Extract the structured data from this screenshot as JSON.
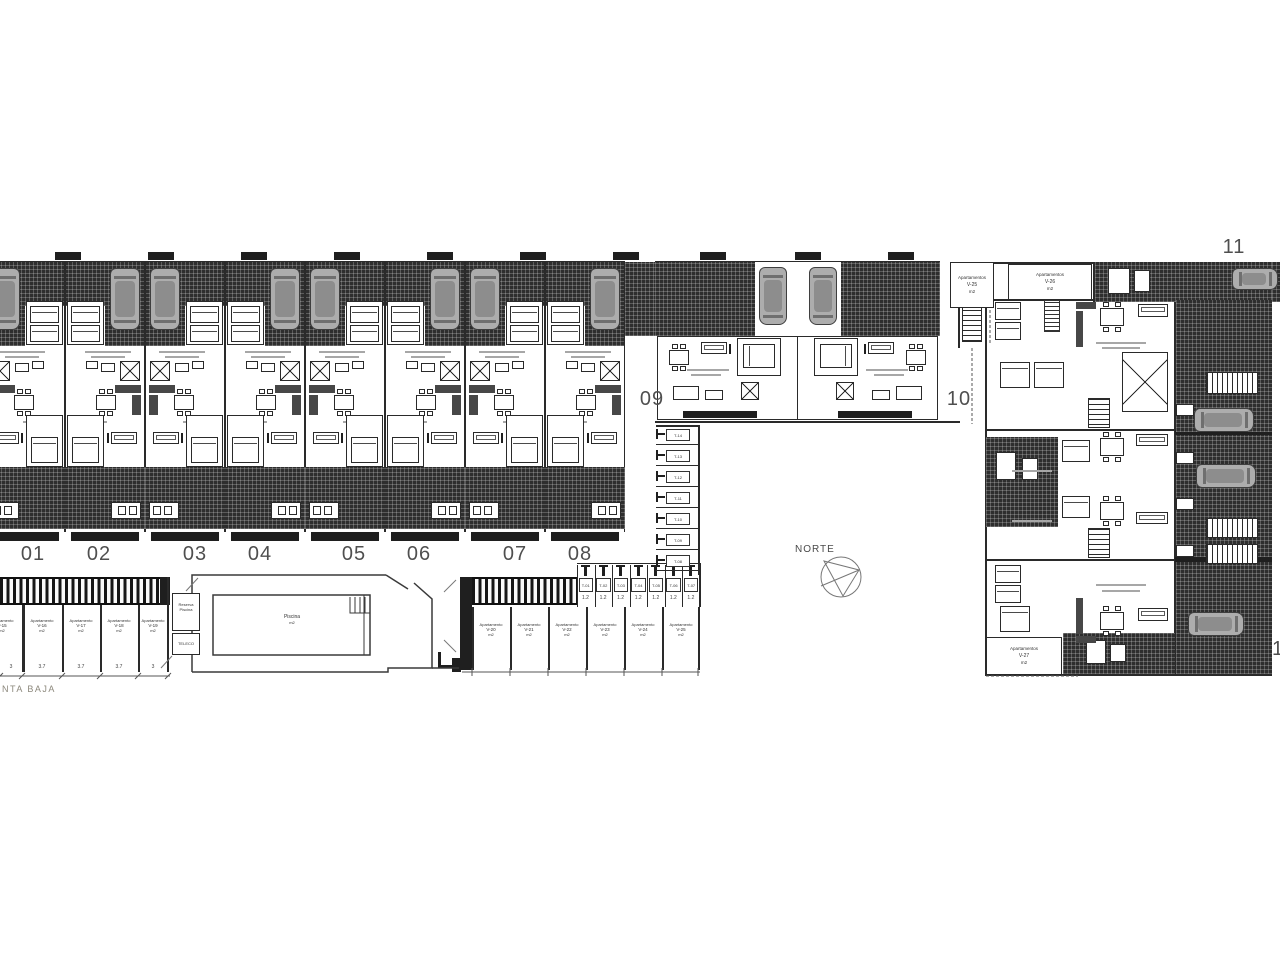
{
  "plan": {
    "floor_label": "NTA BAJA"
  },
  "compass": {
    "label": "NORTE"
  },
  "units": {
    "townhouse_numbers": [
      {
        "label": "01",
        "x": 33
      },
      {
        "label": "02",
        "x": 99
      },
      {
        "label": "03",
        "x": 195
      },
      {
        "label": "04",
        "x": 260
      },
      {
        "label": "05",
        "x": 354
      },
      {
        "label": "06",
        "x": 419
      },
      {
        "label": "07",
        "x": 515
      },
      {
        "label": "08",
        "x": 580
      }
    ],
    "mid_numbers": [
      {
        "label": "09",
        "x": 652
      },
      {
        "label": "10",
        "x": 959
      }
    ],
    "block_number": "11",
    "edge_partial_number": "1"
  },
  "parking_left": {
    "stalls": [
      {
        "line1": "Apartamento",
        "id": "V-15",
        "area": "m2"
      },
      {
        "line1": "Apartamento",
        "id": "V-16",
        "area": "m2"
      },
      {
        "line1": "Apartamento",
        "id": "V-17",
        "area": "m2"
      },
      {
        "line1": "Apartamento",
        "id": "V-18",
        "area": "m2"
      },
      {
        "line1": "Apartamento",
        "id": "V-19",
        "area": "m2"
      }
    ],
    "dims": [
      "3",
      "3.7",
      "3.7",
      "3.7",
      "3"
    ]
  },
  "parking_center": {
    "stalls": [
      {
        "line1": "Apartamento",
        "id": "V-20",
        "area": "m2"
      },
      {
        "line1": "Apartamento",
        "id": "V-21",
        "area": "m2"
      },
      {
        "line1": "Apartamento",
        "id": "V-22",
        "area": "m2"
      },
      {
        "line1": "Apartamento",
        "id": "V-23",
        "area": "m2"
      },
      {
        "line1": "Apartamento",
        "id": "V-24",
        "area": "m2"
      },
      {
        "line1": "Apartamento",
        "id": "V-25",
        "area": "m2"
      }
    ]
  },
  "storage_row": {
    "items": [
      {
        "id": "T-01",
        "dim": "1.2"
      },
      {
        "id": "T-02",
        "dim": "1.2"
      },
      {
        "id": "T-03",
        "dim": "1.2"
      },
      {
        "id": "T-04",
        "dim": "1.2"
      },
      {
        "id": "T-05",
        "dim": "1.2"
      },
      {
        "id": "T-06",
        "dim": "1.2"
      },
      {
        "id": "T-07",
        "dim": "1.2"
      }
    ]
  },
  "storage_col": {
    "items": [
      {
        "id": "T-14"
      },
      {
        "id": "T-13"
      },
      {
        "id": "T-12"
      },
      {
        "id": "T-11"
      },
      {
        "id": "T-10"
      },
      {
        "id": "T-09"
      },
      {
        "id": "T-08"
      }
    ]
  },
  "apartment_boxes": [
    {
      "line1": "Apartamentos",
      "id": "V-25",
      "area": "m2"
    },
    {
      "line1": "Apartamentos",
      "id": "V-26",
      "area": "m2"
    },
    {
      "line1": "Apartamentos",
      "id": "V-27",
      "area": "m2"
    }
  ],
  "pool": {
    "label": "Piscina",
    "sublabel": "m2"
  },
  "rooms": [
    {
      "label": "Reserva Piscina"
    },
    {
      "label": "TELECO"
    }
  ],
  "colors": {
    "line": "#2a2a2a",
    "hatch": "#2e2e2e",
    "car": "#adadad",
    "number": "#4f4f4f",
    "muted": "#8c887c"
  }
}
